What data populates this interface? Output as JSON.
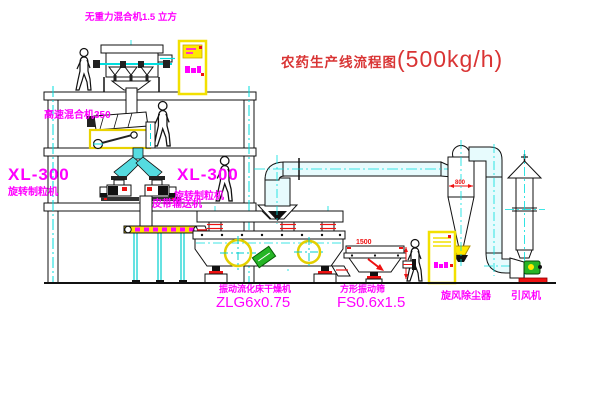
{
  "title": {
    "main": "农药生产线流程图",
    "capacity": "(500kg/h)"
  },
  "equipment_labels": {
    "gravity_mixer": "无重力混合机1.5 立方",
    "high_speed_mixer": "高速混合机350",
    "granulator_left": {
      "model": "XL-300",
      "name": "旋转制粒机"
    },
    "granulator_mid": {
      "model": "XL-300",
      "name": "旋转制粒机"
    },
    "belt_conveyor": "皮带输送机",
    "fluid_bed_dryer": {
      "name": "振动流化床干燥机",
      "model": "ZLG6x0.75"
    },
    "vibrating_sieve": {
      "name": "方形振动筛",
      "model": "FS0.6x1.5"
    },
    "cyclone": "旋风除尘器",
    "induced_draft_fan": "引风机"
  },
  "dimensions": {
    "sieve_length": "1500",
    "cyclone_diameter": "800"
  },
  "colors": {
    "label_magenta": "#ff00ff",
    "title_red": "#d93434",
    "cad_cyan": "#00dede",
    "cad_yellow": "#f2e000",
    "accent_red": "#ee1111",
    "machine_green": "#26b526"
  }
}
